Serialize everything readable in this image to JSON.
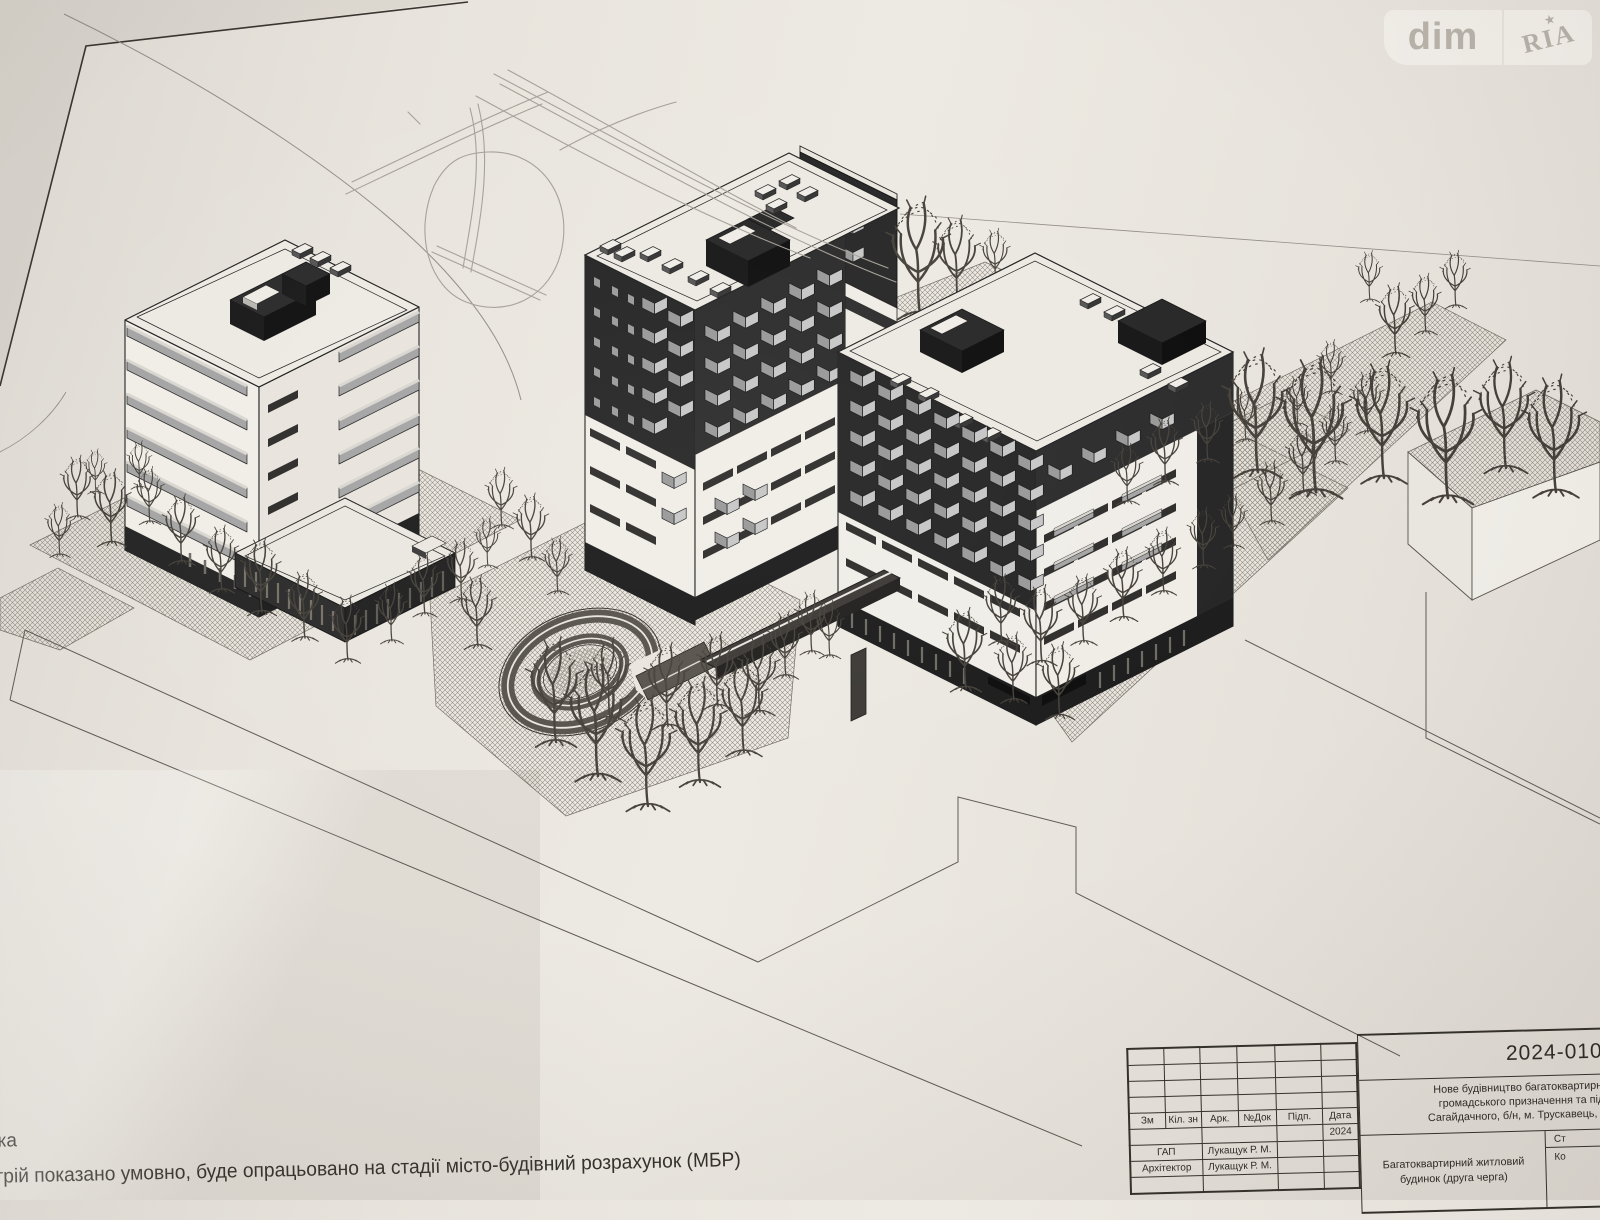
{
  "watermark": {
    "left": "dim",
    "right": "RIA",
    "star": "★"
  },
  "sheet": {
    "notes_line1": "ка",
    "notes_line2": "трій показано умовно, буде опрацьовано на стадії місто-будівний розрахунок (МБР)"
  },
  "stamp": {
    "doc_number": "2024-010-АР",
    "project_line1": "Нове будівництво багатоквартирного житлового будинку",
    "project_line2": "громадського призначення та підземним паркінгом (за",
    "project_line3": "Сагайдачного, б/н, м. Трускавець, Дрогобицький район, Ль",
    "object_name": "Багатоквартирний житловий будинок (друга черга)",
    "col_zm": "Зм",
    "col_kil": "Кіл. зн",
    "col_ark": "Арк.",
    "col_ndok": "№Док",
    "col_pidp": "Підп.",
    "col_data": "Дата",
    "date_value": "2024",
    "row1_role": "ГАП",
    "row1_name": "Лукащук Р. М.",
    "row2_role": "Архітектор",
    "row2_name": "Лукащук Р. М.",
    "right_top": "Ст",
    "right_bottom": "Ко"
  },
  "colors": {
    "paper": "#e9e5de",
    "ink": "#1e1e1e",
    "facade_dark": "#262626",
    "facade_light": "#f1eee8",
    "balcony_gray": "#a6a6a6",
    "hatch_line": "#8f897f",
    "pencil": "#a5a098",
    "watermark_text": "#b4aea5"
  }
}
